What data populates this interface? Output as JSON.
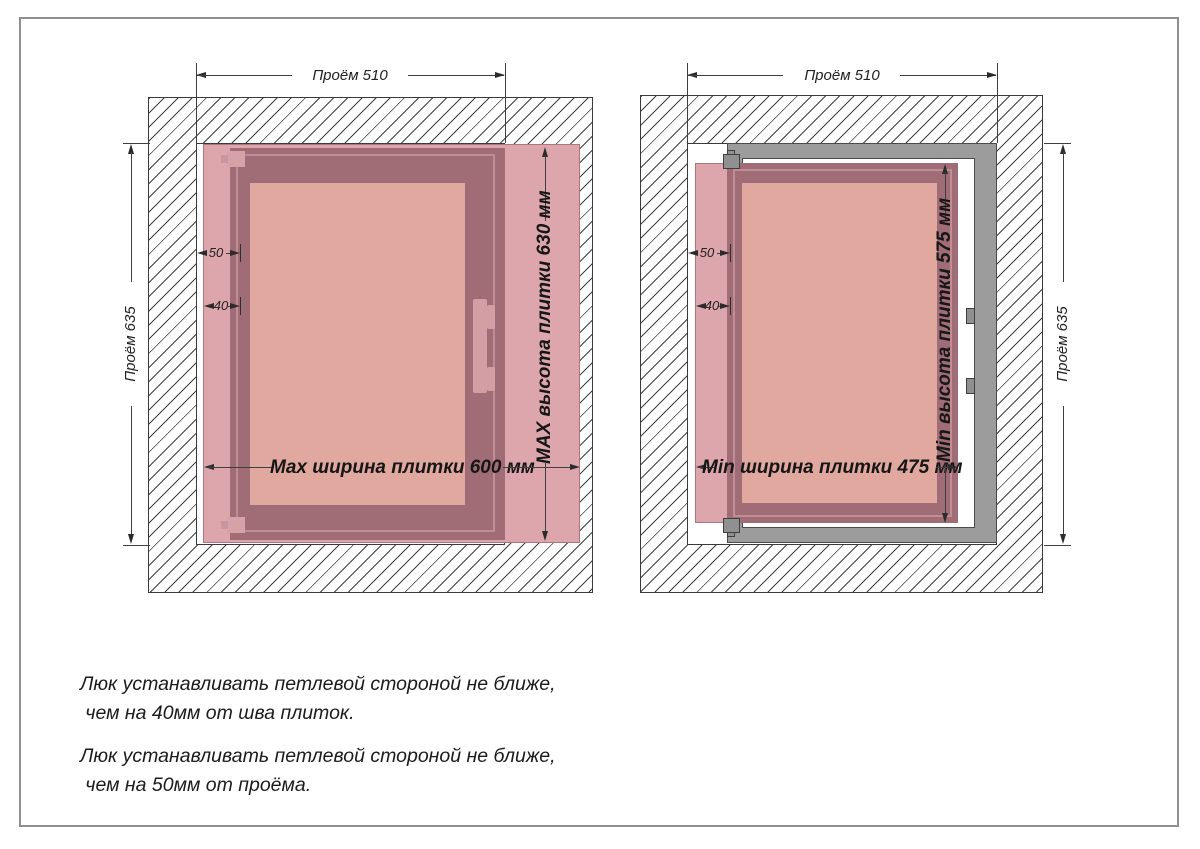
{
  "left_diagram": {
    "top_dim": "Проём 510",
    "side_dim": "Проём 635",
    "hinge_offset_opening": "50",
    "hinge_offset_seam": "40",
    "tile_width": "Max ширина плитки 600 мм",
    "tile_height": "MAX высота плитки 630 мм"
  },
  "right_diagram": {
    "top_dim": "Проём 510",
    "side_dim": "Проём 635",
    "hinge_offset_opening": "50",
    "hinge_offset_seam": "40",
    "tile_width": "Min ширина плитки 475 мм",
    "tile_height": "Min высота плитки 575 мм"
  },
  "notes": {
    "note1_line1": "Люк устанавливать петлевой стороной не ближе,",
    "note1_line2": " чем на 40мм от шва плиток.",
    "note2_line1": "Люк устанавливать петлевой стороной не ближе,",
    "note2_line2": " чем на 50мм от проёма."
  },
  "colors": {
    "tile": "#dca6ac",
    "hatch_frame": "#a06d77",
    "door_panel": "#e0a89f",
    "metal_frame": "#9c9c9c",
    "dimension_lines": "#2b2b2b"
  }
}
